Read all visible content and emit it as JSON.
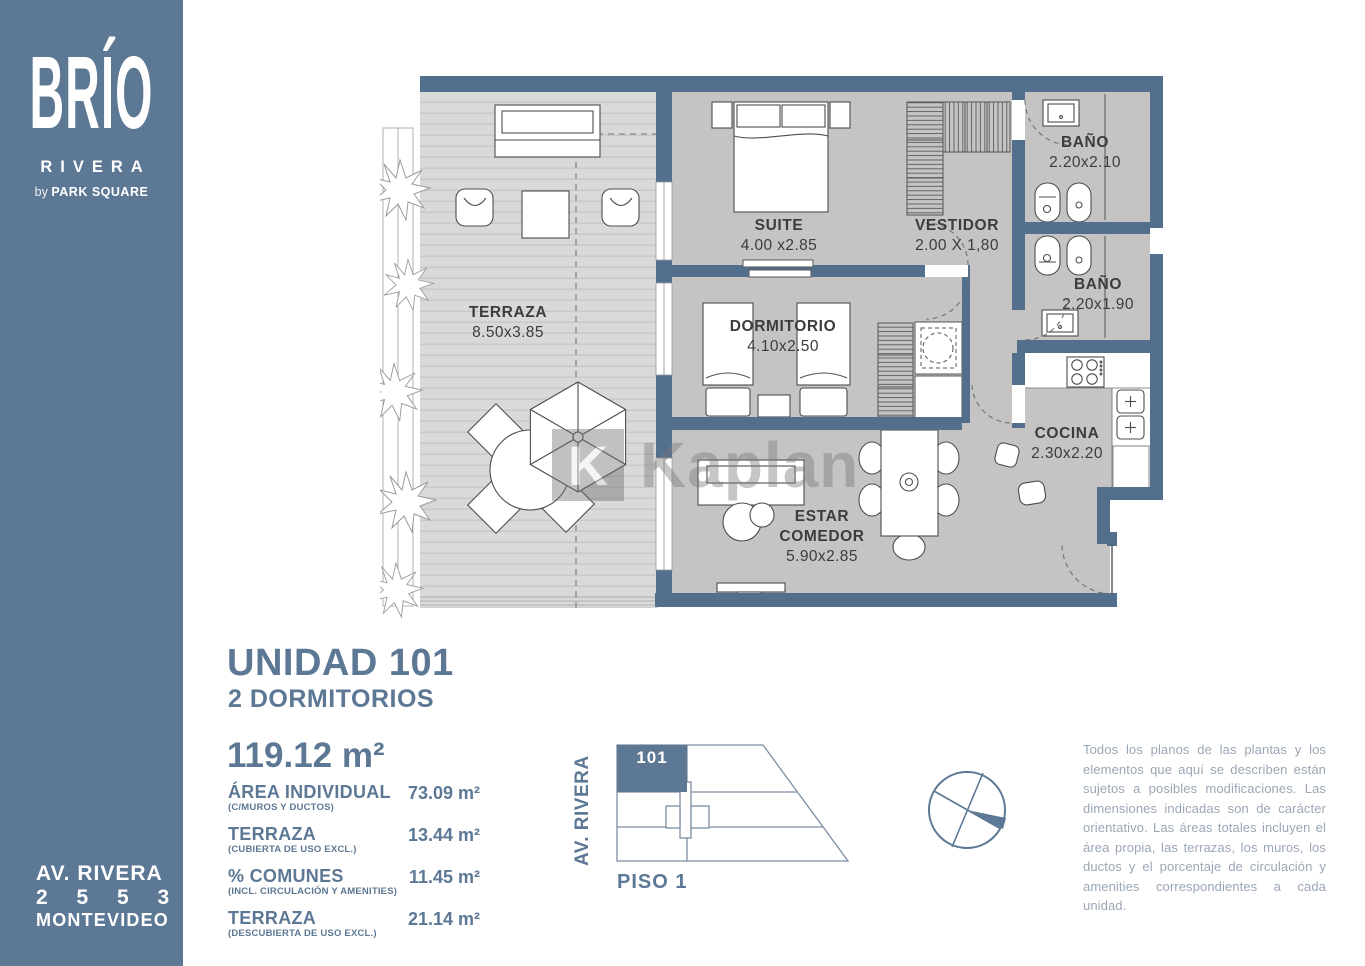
{
  "sidebar": {
    "logo": {
      "brand": "BRÍO",
      "line2": "RIVERA",
      "by": "by",
      "by_brand": "PARK SQUARE"
    },
    "address": {
      "line1": "AV. RIVERA",
      "line2": "2 5 5 3",
      "line3": "MONTEVIDEO"
    }
  },
  "plan": {
    "watermark_k": "K",
    "watermark": "Kaplan",
    "rooms": [
      {
        "id": "terraza",
        "name": "TERRAZA",
        "dims": "8.50x3.85"
      },
      {
        "id": "suite",
        "name": "SUITE",
        "dims": "4.00 x2.85"
      },
      {
        "id": "vestidor",
        "name": "VESTIDOR",
        "dims": "2.00 X 1,80"
      },
      {
        "id": "bano1",
        "name": "BAÑO",
        "dims": "2.20x2.10"
      },
      {
        "id": "bano2",
        "name": "BAÑO",
        "dims": "2.20x1.90"
      },
      {
        "id": "dormitorio",
        "name": "DORMITORIO",
        "dims": "4.10x2.50"
      },
      {
        "id": "cocina",
        "name": "COCINA",
        "dims": "2.30x2.20"
      },
      {
        "id": "estar",
        "name": "ESTAR",
        "name2": "COMEDOR",
        "dims": "5.90x2.85"
      }
    ]
  },
  "unit": {
    "title": "UNIDAD 101",
    "subtitle": "2 DORMITORIOS",
    "total_area": "119.12 m²",
    "areas": [
      {
        "label": "ÁREA INDIVIDUAL",
        "sublabel": "(C/MUROS Y DUCTOS)",
        "value": "73.09 m²"
      },
      {
        "label": "TERRAZA",
        "sublabel": "(CUBIERTA DE USO EXCL.)",
        "value": "13.44 m²"
      },
      {
        "label": "% COMUNES",
        "sublabel": "(INCL. CIRCULACIÓN Y AMENITIES)",
        "value": "11.45 m²"
      },
      {
        "label": "TERRAZA",
        "sublabel": "(DESCUBIERTA DE USO EXCL.)",
        "value": "21.14 m²"
      }
    ]
  },
  "sitemap": {
    "street": "AV. RIVERA",
    "unit": "101",
    "floor": "PISO 1"
  },
  "disclaimer": "Todos los planos de las plantas y los elementos que aquí se describen están sujetos a posibles modificaciones. Las dimensiones indicadas son de carácter orientativo. Las áreas totales incluyen el área propia, las terrazas, los muros, los ductos y el porcentaje de circulación y amenities correspondientes a cada unidad.",
  "colors": {
    "brand": "#5d7894",
    "wall": "#536f8e",
    "floor": "#c5c4c2",
    "deck": "#d9d9d7"
  }
}
